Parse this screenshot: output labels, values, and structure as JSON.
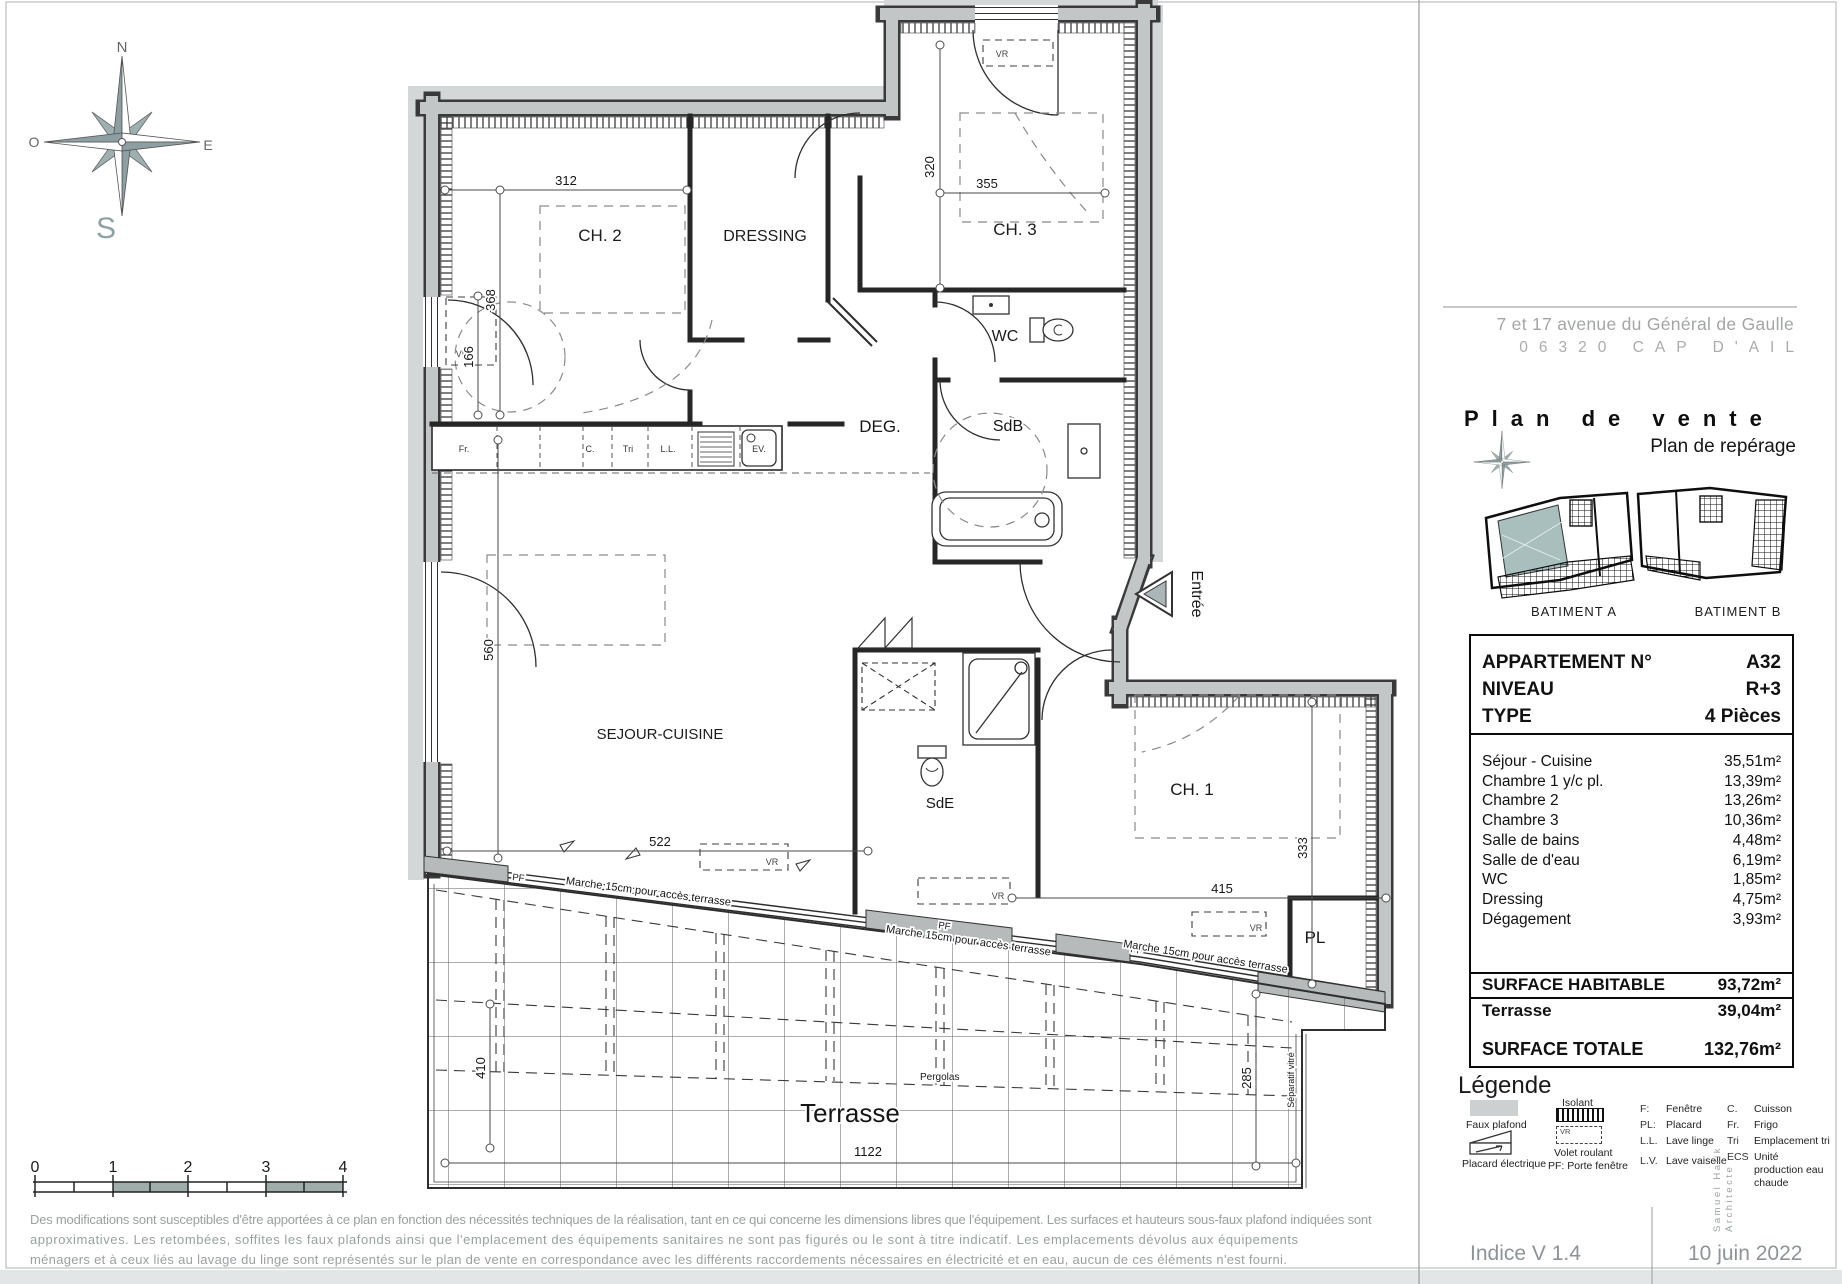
{
  "header": {
    "address_line1": "7 et 17 avenue du Général de Gaulle",
    "address_line2": "06320 CAP D'AIL",
    "title": "Plan de vente",
    "subtitle": "Plan de repérage"
  },
  "compass": {
    "n": "N",
    "o": "O",
    "e": "E",
    "s": "S"
  },
  "key_plan": {
    "batiment_a": "BATIMENT  A",
    "batiment_b": "BATIMENT B",
    "highlight_color": "#a8bfbe"
  },
  "plan": {
    "rooms": {
      "ch2": "CH. 2",
      "dressing": "DRESSING",
      "ch3": "CH. 3",
      "wc": "WC",
      "deg": "DEG.",
      "sdb": "SdB",
      "sejour": "SEJOUR-CUISINE",
      "sde": "SdE",
      "ch1": "CH. 1",
      "pl": "PL",
      "terrasse": "Terrasse",
      "entree": "Entrée"
    },
    "dims": {
      "d312": "312",
      "d320": "320",
      "d355": "355",
      "d368": "368",
      "d166": "166",
      "d560": "560",
      "d522": "522",
      "d415": "415",
      "d333": "333",
      "d1122": "1122",
      "d410": "410",
      "d285": "285"
    },
    "kitchen": {
      "fr": "Fr.",
      "c": "C.",
      "tri": "Tri",
      "ll": "L.L.",
      "ev": "EV."
    },
    "annotations": {
      "vr": "VR",
      "pf": "PF",
      "marche": "Marche 15cm pour accès terrasse",
      "pergolas": "Pergolas",
      "separatif": "Séparatif vitré"
    }
  },
  "scale_bar": {
    "labels": [
      "0",
      "1",
      "2",
      "3",
      "4"
    ]
  },
  "info_table": {
    "header": {
      "rows": [
        {
          "label": "APPARTEMENT N°",
          "value": "A32"
        },
        {
          "label": "NIVEAU",
          "value": "R+3"
        },
        {
          "label": "TYPE",
          "value": "4 Pièces"
        }
      ]
    },
    "areas": [
      {
        "label": "Séjour - Cuisine",
        "value": "35,51m²"
      },
      {
        "label": "Chambre 1 y/c pl.",
        "value": "13,39m²"
      },
      {
        "label": "Chambre 2",
        "value": "13,26m²"
      },
      {
        "label": "Chambre 3",
        "value": "10,36m²"
      },
      {
        "label": "Salle de bains",
        "value": "4,48m²"
      },
      {
        "label": "Salle de d'eau",
        "value": "6,19m²"
      },
      {
        "label": "WC",
        "value": "1,85m²"
      },
      {
        "label": "Dressing",
        "value": "4,75m²"
      },
      {
        "label": "Dégagement",
        "value": "3,93m²"
      }
    ],
    "surface_habitable": {
      "label": "SURFACE HABITABLE",
      "value": "93,72m²"
    },
    "terrasse": {
      "label": "Terrasse",
      "value": "39,04m²"
    },
    "surface_totale": {
      "label": "SURFACE TOTALE",
      "value": "132,76m²"
    }
  },
  "legend": {
    "title": "Légende",
    "faux_plafond": "Faux plafond",
    "placard_electrique": "Placard électrique",
    "isolant": "Isolant",
    "vr": "VR",
    "volet_roulant": "Volet roulant",
    "pf_item": "PF:  Porte fenêtre",
    "abbr": [
      {
        "k": "F:",
        "v": "Fenêtre"
      },
      {
        "k": "PL:",
        "v": "Placard"
      },
      {
        "k": "L.L.",
        "v": "Lave linge"
      },
      {
        "k": "L.V.",
        "v": "Lave vaiselle"
      },
      {
        "k": "C.",
        "v": "Cuisson"
      },
      {
        "k": "Fr.",
        "v": "Frigo"
      },
      {
        "k": "Tri",
        "v": "Emplacement tri"
      },
      {
        "k": "ECS",
        "v": "Unité production eau chaude"
      }
    ]
  },
  "footer": {
    "line1": "Des modifications sont susceptibles d'être apportées à ce plan en fonction des nécessités techniques de la réalisation, tant en ce qui concerne les dimensions libres que l'équipement. Les surfaces et hauteurs sous-faux plafond indiquées sont",
    "line2": "approximatives. Les retombées, soffites les faux plafonds ainsi que l'emplacement des équipements sanitaires ne sont pas figurés ou le sont à titre indicatif. Les emplacements dévolus aux équipements",
    "line3": "ménagers et à ceux liés au lavage du linge sont représentés sur le plan de vente en correspondance avec les différents raccordements nécessaires en électricité et en eau, aucun de ces éléments n'est fourni.",
    "indice": "Indice  V 1.4",
    "date": "10 juin 2022",
    "architect_line1": "Samuel Halik",
    "architect_line2": "Architecte"
  }
}
